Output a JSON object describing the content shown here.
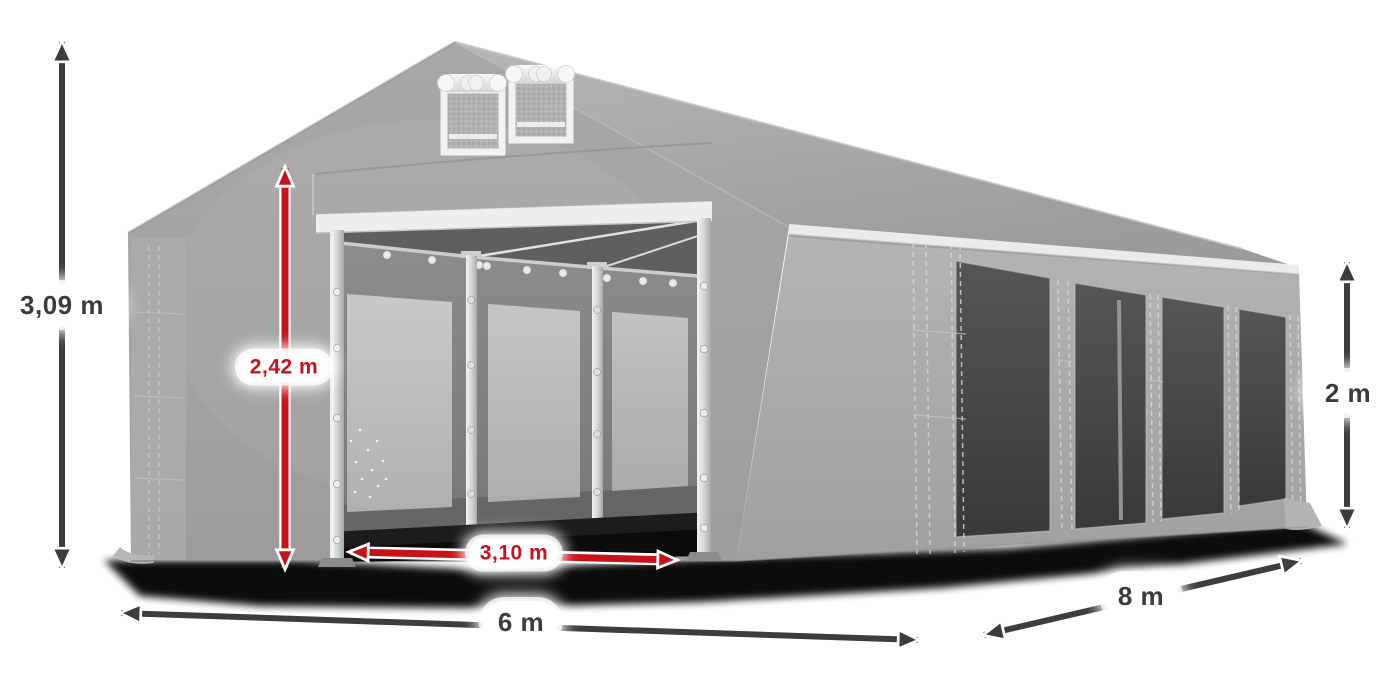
{
  "diagram": {
    "labels": {
      "total_height": "3,09 m",
      "entrance_height": "2,42 m",
      "entrance_width": "3,10 m",
      "front_width": "6 m",
      "side_length": "8 m",
      "wall_height": "2 m"
    },
    "colors": {
      "accent_red": "#c81118",
      "arrow_dark": "#3d3d3d",
      "label_text": "#3c3c3c",
      "tent_gray": "#a5a5a5",
      "roof_trim_white": "#ebebeb",
      "window_dark": "#454545",
      "background": "#ffffff"
    }
  }
}
